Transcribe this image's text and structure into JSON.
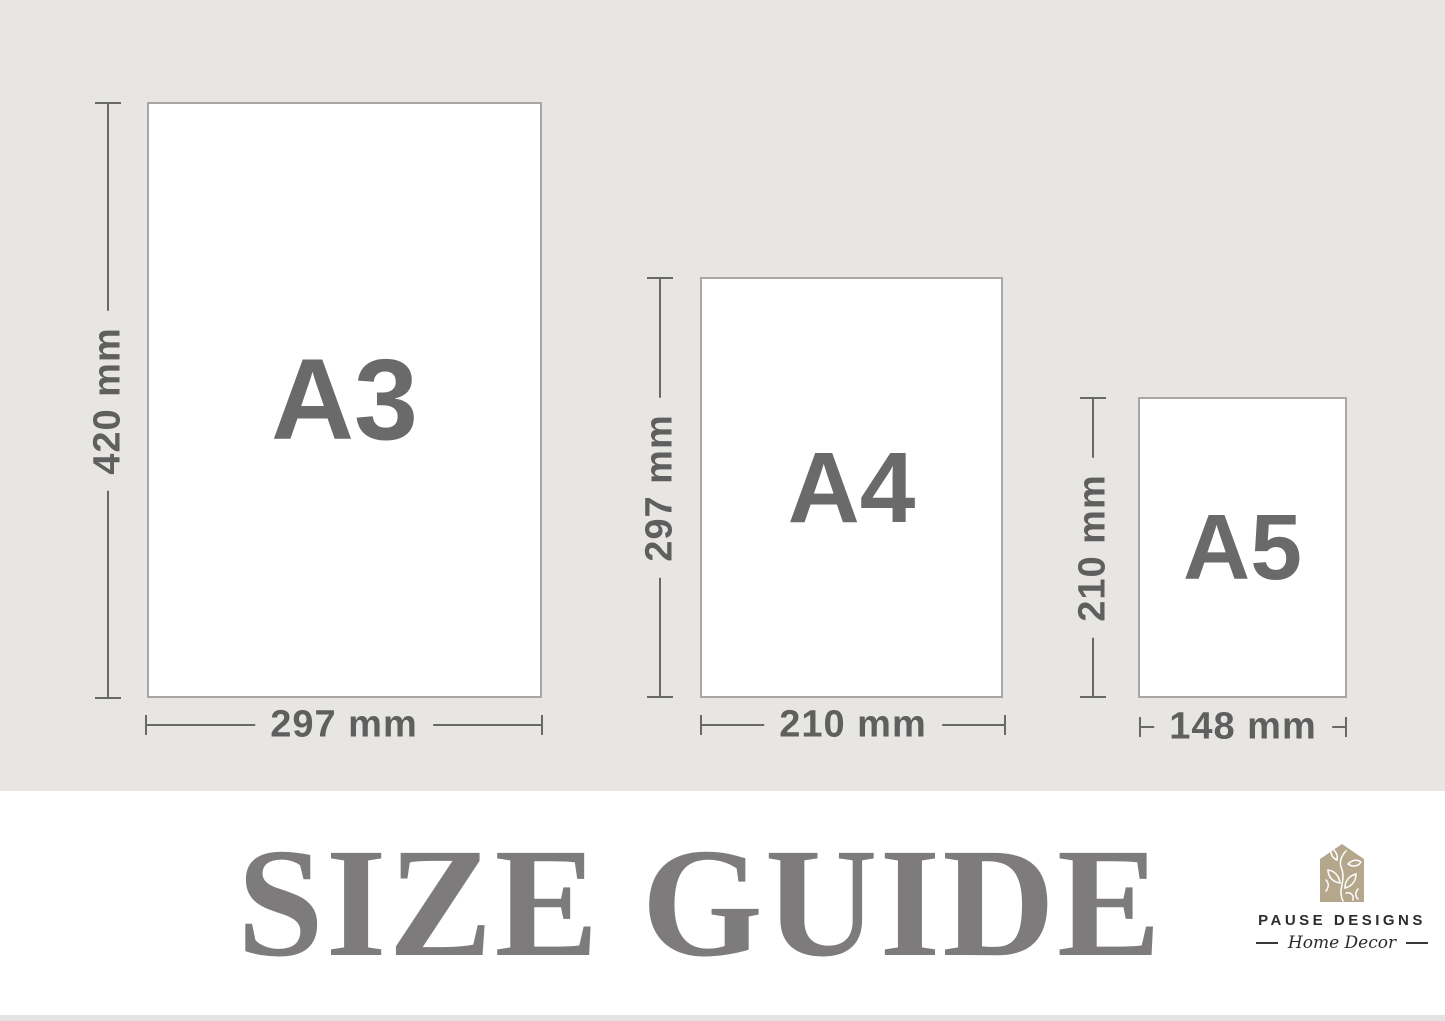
{
  "page": {
    "title": "SIZE GUIDE"
  },
  "papers": [
    {
      "name": "A3",
      "height_label": "420 mm",
      "width_label": "297 mm"
    },
    {
      "name": "A4",
      "height_label": "297 mm",
      "width_label": "210 mm"
    },
    {
      "name": "A5",
      "height_label": "210 mm",
      "width_label": "148 mm"
    }
  ],
  "brand": {
    "name": "PAUSE DESIGNS",
    "tagline": "Home Decor",
    "icon": "floral-house-icon",
    "icon_color": "#b5a78c"
  },
  "colors": {
    "background": "#e8e6e3",
    "paper_fill": "#ffffff",
    "paper_border": "#a9a7a5",
    "dimension_line": "#686868",
    "dimension_text": "#5f5f5f",
    "title_text": "#7e7b7c",
    "brand_text": "#2e2c29"
  }
}
